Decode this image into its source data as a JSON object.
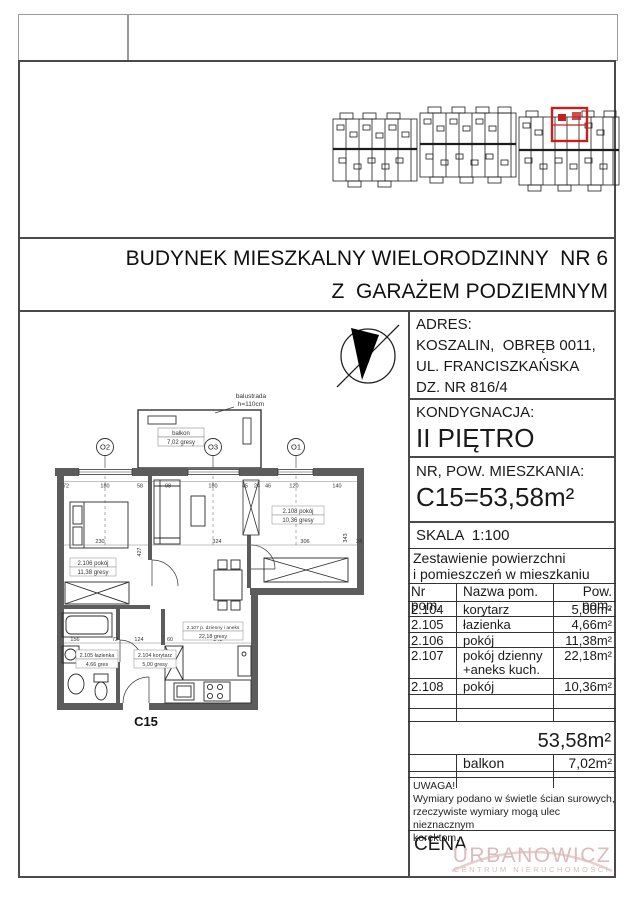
{
  "header": {
    "title_line1": "BUDYNEK MIESZKALNY WIELORODZINNY  NR 6",
    "title_line2": "Z  GARAŻEM PODZIEMNYM"
  },
  "info": {
    "adres_label": "ADRES:",
    "adres_lines": [
      "KOSZALIN,  OBRĘB 0011,",
      "UL. FRANCISZKAŃSKA",
      "DZ. NR 816/4"
    ],
    "kondygnacja_label": "KONDYGNACJA:",
    "kondygnacja_value": "II PIĘTRO",
    "nr_pow_label": "NR, POW. MIESZKANIA:",
    "nr_pow_value": "C15=53,58m²",
    "skala": "SKALA  1:100"
  },
  "table": {
    "title_line1": "Zestawienie powierzchni",
    "title_line2": "i pomieszczeń w mieszkaniu",
    "headers": [
      "Nr pom.",
      "Nazwa pom.",
      "Pow. pom."
    ],
    "rows": [
      {
        "nr": "2.104",
        "name": "korytarz",
        "area": "5,00m²"
      },
      {
        "nr": "2.105",
        "name": "łazienka",
        "area": "4,66m²"
      },
      {
        "nr": "2.106",
        "name": "pokój",
        "area": "11,38m²"
      },
      {
        "nr": "2.107",
        "name": "pokój dzienny\n+aneks kuch.",
        "area": "22,18m²"
      },
      {
        "nr": "2.108",
        "name": "pokój",
        "area": "10,36m²"
      }
    ],
    "total": "53,58m²",
    "balkon_row": {
      "name": "balkon",
      "area": "7,02m²"
    }
  },
  "notes": {
    "uwaga_title": "UWAGA!",
    "lines": [
      "Wymiary podano w świetle ścian surowych,",
      "rzeczywiste wymiary mogą ulec nieznacznym",
      "korektom."
    ],
    "cena_label": "CENA"
  },
  "watermark": {
    "line1": "URBANOWICZ",
    "line2": "CENTRUM NIERUCHOMOŚCI",
    "accent_color": "#c81e1e"
  },
  "plan": {
    "unit_label": "C15",
    "axes": [
      "O2",
      "O3",
      "O1"
    ],
    "balustrade_note_line1": "balustrada",
    "balustrade_note_line2": "h=110cm",
    "balcony": {
      "line1": "balkon",
      "line2": "7,02 gresy"
    },
    "rooms": [
      {
        "line1": "2.106 pokój",
        "line2": "11,38 gresy"
      },
      {
        "line1": "2.105 łazienka",
        "line2": "4,66 gres"
      },
      {
        "line1": "2.104 korytarz",
        "line2": "5,00 gresy"
      },
      {
        "line1": "2.107 p. dzienny i aneks",
        "line2": "22,18 gresy"
      },
      {
        "line1": "2.108 pokój",
        "line2": "10,36 gresy"
      }
    ],
    "dims_top": [
      "72",
      "180",
      "58",
      "98",
      "180",
      "45",
      "24",
      "46",
      "120",
      "140"
    ],
    "dims_mid": [
      "230",
      "324",
      "306",
      "24"
    ],
    "dims_lower": [
      "156",
      "72",
      "124",
      "60",
      "242"
    ],
    "dims_vertical": [
      "427",
      "343"
    ]
  }
}
